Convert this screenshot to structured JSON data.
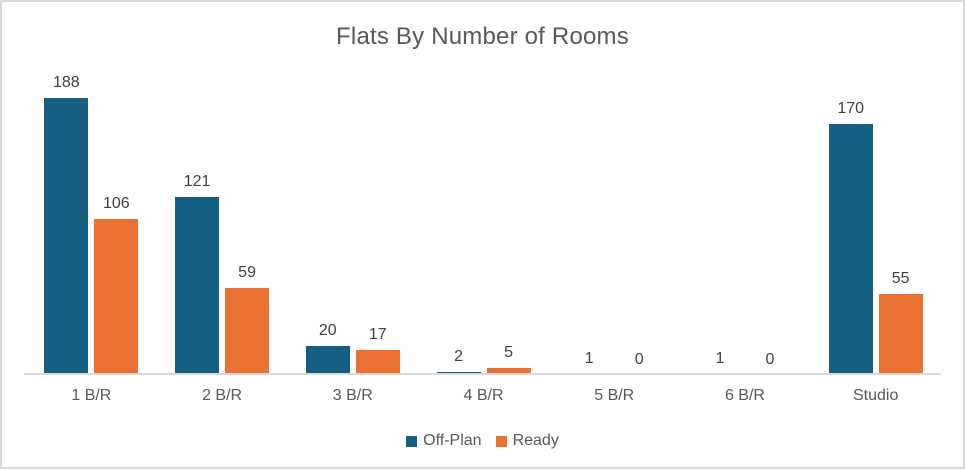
{
  "chart_data": {
    "type": "bar",
    "title": "Flats By Number of Rooms",
    "categories": [
      "1 B/R",
      "2 B/R",
      "3 B/R",
      "4 B/R",
      "5 B/R",
      "6 B/R",
      "Studio"
    ],
    "series": [
      {
        "name": "Off-Plan",
        "color": "#156082",
        "values": [
          188,
          121,
          20,
          2,
          1,
          1,
          170
        ]
      },
      {
        "name": "Ready",
        "color": "#E97132",
        "values": [
          106,
          59,
          17,
          5,
          0,
          0,
          55
        ]
      }
    ],
    "xlabel": "",
    "ylabel": "",
    "ylim": [
      0,
      200
    ],
    "grid": false,
    "data_labels": true,
    "legend_position": "bottom",
    "axis_line_color": "#D9D9D9",
    "frame_border_color": "#D9D9D9",
    "text_colors": {
      "title": "#595959",
      "data_label": "#404040",
      "category_label": "#595959",
      "legend": "#595959"
    }
  }
}
